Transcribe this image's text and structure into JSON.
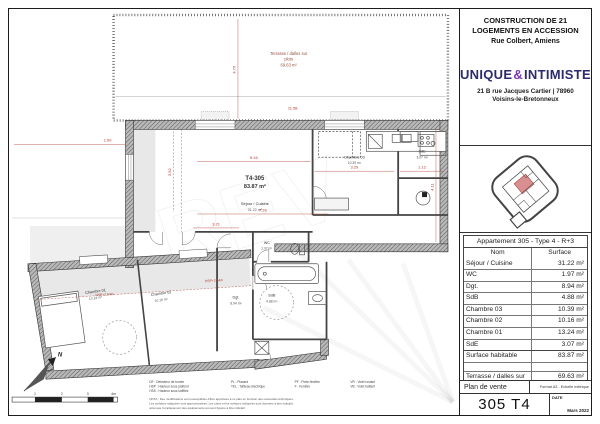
{
  "doc": {
    "project_title": "CONSTRUCTION DE 21 LOGEMENTS EN ACCESSION",
    "project_location": "Rue Colbert, Amiens",
    "brand": {
      "part1": "UNIQUE",
      "amp": "&",
      "part2": "INTIMISTE",
      "address1": "21 B rue Jacques Cartier | 78960",
      "address2": "Voisins-le-Bretonneux"
    },
    "apartment_table": {
      "title": "Appartement 305 - Type 4 - R+3",
      "col_name": "Nom",
      "col_surface": "Surface",
      "rows": [
        {
          "name": "Séjour / Cuisine",
          "surface": "31.22 m²",
          "kind": "data"
        },
        {
          "name": "WC",
          "surface": "1.97 m²",
          "kind": "data"
        },
        {
          "name": "Dgt.",
          "surface": "8.94 m²",
          "kind": "data"
        },
        {
          "name": "SdB",
          "surface": "4.88 m²",
          "kind": "data"
        },
        {
          "name": "Chambre 03",
          "surface": "10.39 m²",
          "kind": "data"
        },
        {
          "name": "Chambre 02",
          "surface": "10.16 m²",
          "kind": "data"
        },
        {
          "name": "Chambre 01",
          "surface": "13.24 m²",
          "kind": "data"
        },
        {
          "name": "SdE",
          "surface": "3.07 m²",
          "kind": "data"
        },
        {
          "name": "Surface habitable",
          "surface": "83.87 m²",
          "kind": "total"
        },
        {
          "name": "",
          "surface": "",
          "kind": "spacer"
        },
        {
          "name": "Terrasse / dalles sur plots",
          "surface": "69.63 m²",
          "kind": "exterior"
        },
        {
          "name": "surface exterieure",
          "surface": "69.63 m²",
          "kind": "exterior"
        }
      ]
    },
    "footer": {
      "doc_type": "Plan de vente",
      "format_note": "Format A3 - Echelle métrique",
      "unit": "305 T4",
      "date_label": "DATE",
      "date_value": "Mars 2022"
    }
  },
  "plan": {
    "unit_code": "T4-305",
    "unit_area": "83.87 m²",
    "terrace": {
      "line1": "Terrasse / dalles sur",
      "line2": "plots",
      "area": "69.63 m²"
    },
    "rooms": [
      {
        "name": "Séjour / Cuisine",
        "area": "31.22 m²"
      },
      {
        "name": "Chambre 03",
        "area": "10.39 m²"
      },
      {
        "name": "SdE",
        "area": "3.07 m²"
      },
      {
        "name": "WC",
        "area": "1.97 m²"
      },
      {
        "name": "SdB",
        "area": "4.88 m²"
      },
      {
        "name": "Dgt.",
        "area": "8.94 m²"
      },
      {
        "name": "Chambre 02",
        "area": "10.16 m²"
      },
      {
        "name": "Chambre 01",
        "area": "13.24 m²"
      }
    ],
    "dimensions": [
      "4.70",
      "11.58",
      "1.99",
      "5.16",
      "7.28",
      "3.21",
      "3.29",
      "1.12",
      "3.92",
      "4.11"
    ],
    "hsp_label": "HSP+2.54m",
    "north_label": "N",
    "scale_ticks": [
      "1",
      "2",
      "3",
      "4m"
    ],
    "watermark": "REV"
  },
  "legend": {
    "columns": [
      [
        "DF : Détecteur de fumée",
        "HSP : Hauteur sous plafond",
        "HSS : Hauteur sous soffites"
      ],
      [
        "PL : Placard",
        "TEL : Tableau électrique"
      ],
      [
        "PF : Porte-fenêtre",
        "F : Fenêtre"
      ],
      [
        "VR : Volet roulant",
        "VB : Volet battant"
      ]
    ],
    "nota_lines": [
      "NOTA : Des modifications sont susceptibles d'être apportées à ce plan en fonction des nécessités techniques.",
      "Les surfaces indiquées sont approximatives. Les côtes et les surfaces indiquées sont données à titre indicatif,",
      "ainsi que l'emplacement des équipements qui sont figurés à titre indicatif."
    ]
  },
  "colors": {
    "dimension_red": "#b03a2e",
    "brand_navy": "#2b2b6e",
    "brand_purple": "#7a3bb5",
    "keyplan_unit": "#d98f8f"
  }
}
